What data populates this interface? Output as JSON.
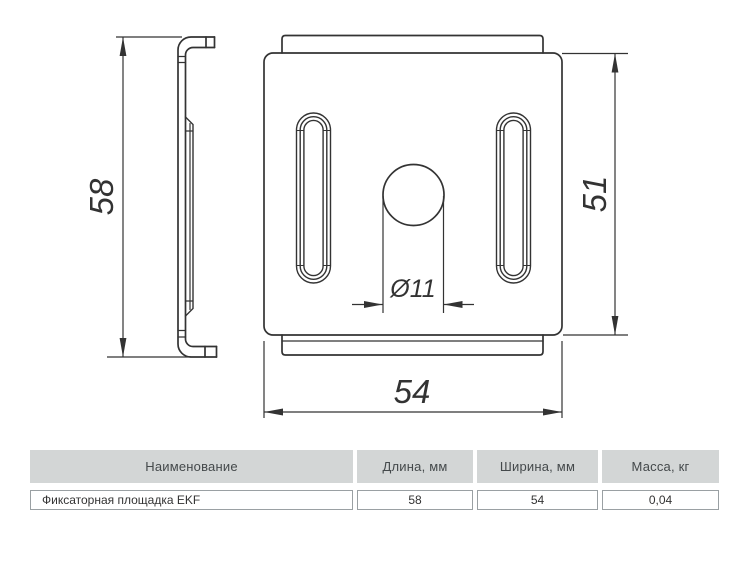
{
  "drawing": {
    "height_label": "58",
    "side_label": "51",
    "width_label": "54",
    "hole_label": "Ø11"
  },
  "table": {
    "headers": [
      "Наименование",
      "Длина, мм",
      "Ширина, мм",
      "Масса, кг"
    ],
    "rows": [
      {
        "name": "Фиксаторная площадка EKF",
        "length": "58",
        "width": "54",
        "mass": "0,04"
      }
    ]
  },
  "colors": {
    "line": "#333333",
    "table_header_bg": "#d3d6d6",
    "table_border": "#9aa0a3",
    "background": "#ffffff"
  }
}
